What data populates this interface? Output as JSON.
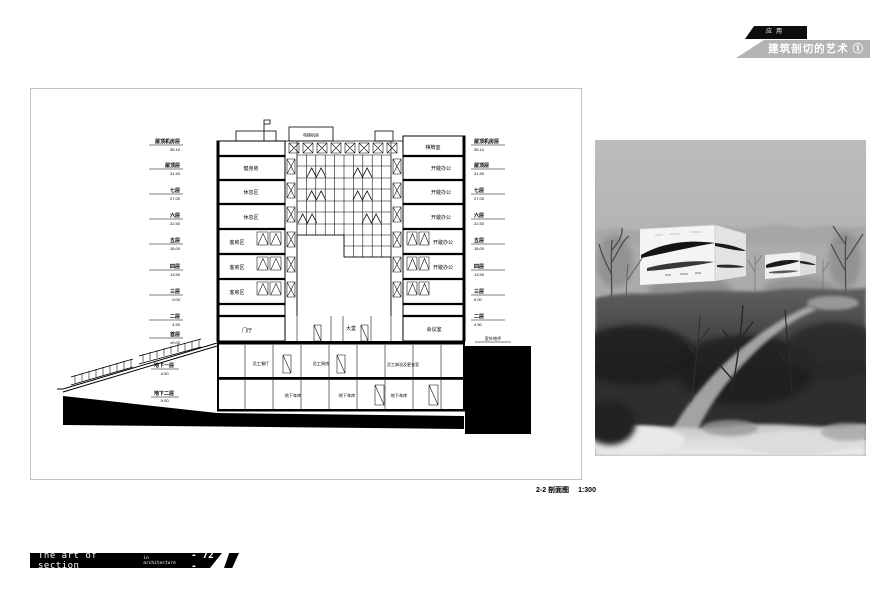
{
  "header": {
    "tab": "应用",
    "title": "建筑剖切的艺术",
    "badge": "①"
  },
  "footer": {
    "series": "The art of section",
    "series_sub": "in architecture",
    "page": "- 72 -"
  },
  "caption": {
    "name": "2-2 剖面图",
    "scale": "1:300"
  },
  "colors": {
    "ink": "#000000",
    "header_strip": "#b4b4b4",
    "photo_sky": "#b6b6b6"
  },
  "levels": [
    {
      "name": "屋顶机房层",
      "elev": "35.10"
    },
    {
      "name": "屋顶层",
      "elev": "31.50"
    },
    {
      "name": "七层",
      "elev": "27.00"
    },
    {
      "name": "六层",
      "elev": "22.50"
    },
    {
      "name": "五层",
      "elev": "18.00"
    },
    {
      "name": "四层",
      "elev": "13.50"
    },
    {
      "name": "三层",
      "elev": "9.00"
    },
    {
      "name": "二层",
      "elev": "4.50"
    },
    {
      "name": "首层",
      "elev": "±0.00"
    }
  ],
  "basement_levels": [
    {
      "name": "地下一层",
      "elev": "-4.50"
    },
    {
      "name": "地下二层",
      "elev": "-9.00"
    }
  ],
  "site": {
    "grade_label": "室外地坪"
  },
  "rooms": {
    "roof": "电梯机房",
    "left_tower": [
      "健身房",
      "休息区",
      "休息区",
      "客房区",
      "客房区",
      "客房区"
    ],
    "right_tower": [
      "棋牌室",
      "开敞办公",
      "开敞办公",
      "开敞办公",
      "开敞办公",
      "开敞办公"
    ],
    "ground": [
      "门厅",
      "大堂",
      "会议室"
    ],
    "b1": [
      "员工餐厅",
      "员工厨房",
      "员工淋浴及更衣室"
    ],
    "b2": [
      "地下车库",
      "地下车库",
      "地下车库"
    ]
  }
}
